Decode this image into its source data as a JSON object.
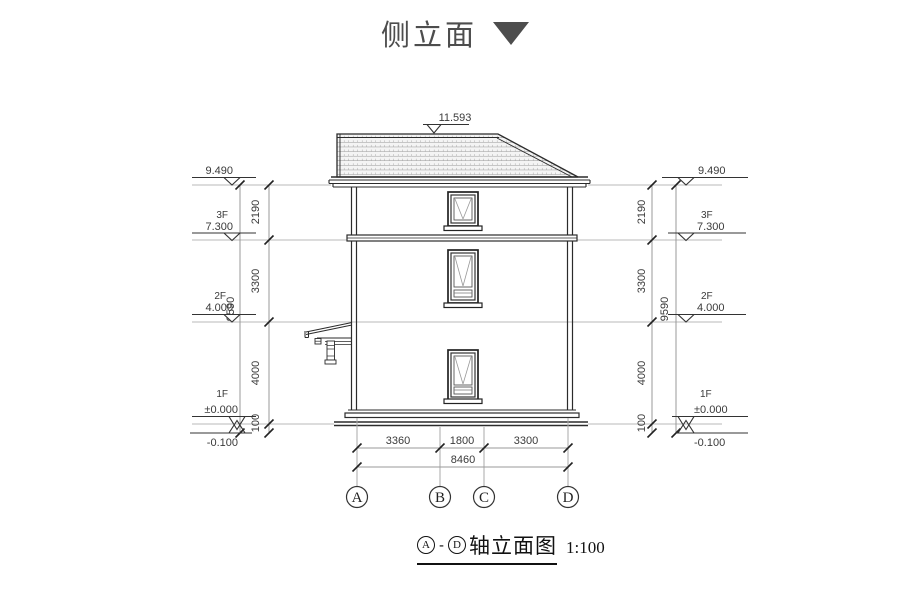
{
  "title": {
    "text": "侧立面"
  },
  "levels": {
    "peak": "11.593",
    "eave": "9.490",
    "f3_label": "3F",
    "f3": "7.300",
    "f2_label": "2F",
    "f2": "4.000",
    "f1_label": "1F",
    "f1": "±0.000",
    "ground": "-0.100"
  },
  "vdims": {
    "d2190": "2190",
    "d3300": "3300",
    "d4000": "4000",
    "d100": "100",
    "total": "9590"
  },
  "hdims": {
    "ab": "3360",
    "bc": "1800",
    "cd": "3300",
    "total": "8460"
  },
  "axes": [
    "A",
    "B",
    "C",
    "D"
  ],
  "caption": {
    "from": "A",
    "dash": "-",
    "to": "D",
    "text": "轴立面图",
    "scale": "1:100"
  },
  "colors": {
    "line": "#2b2b2b",
    "light_line": "#b8b8b8",
    "dim_line": "#999999",
    "text": "#3a3a3a",
    "title": "#4d4d4d"
  }
}
